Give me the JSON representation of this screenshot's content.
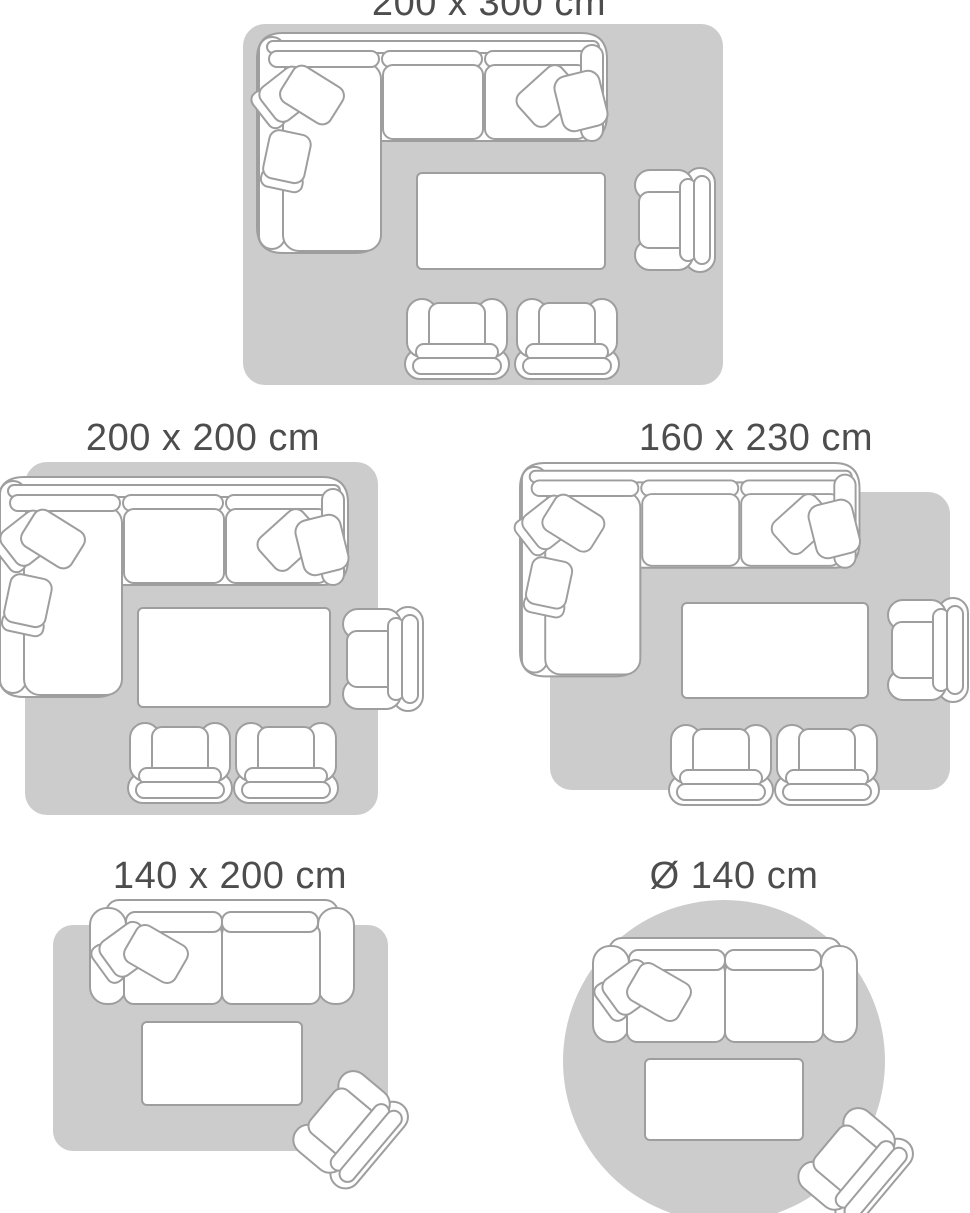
{
  "colors": {
    "background": "#ffffff",
    "rug": "#cccccc",
    "outline": "#9e9e9e",
    "furniture_fill": "#ffffff",
    "title_text": "#4d4d4d"
  },
  "diagrams": [
    {
      "label": "200 x 300 cm",
      "rug_shape": "rectangle",
      "furniture": [
        "corner-sofa",
        "coffee-table",
        "armchair",
        "armchair",
        "armchair"
      ]
    },
    {
      "label": "200 x 200 cm",
      "rug_shape": "square",
      "furniture": [
        "corner-sofa",
        "coffee-table",
        "armchair",
        "armchair",
        "armchair"
      ]
    },
    {
      "label": "160 x 230 cm",
      "rug_shape": "rectangle",
      "furniture": [
        "corner-sofa",
        "coffee-table",
        "armchair",
        "armchair",
        "armchair"
      ]
    },
    {
      "label": "140 x 200 cm",
      "rug_shape": "rectangle",
      "furniture": [
        "sofa",
        "coffee-table",
        "armchair"
      ]
    },
    {
      "label": "Ø 140 cm",
      "rug_shape": "circle",
      "furniture": [
        "sofa",
        "coffee-table",
        "armchair"
      ]
    }
  ]
}
